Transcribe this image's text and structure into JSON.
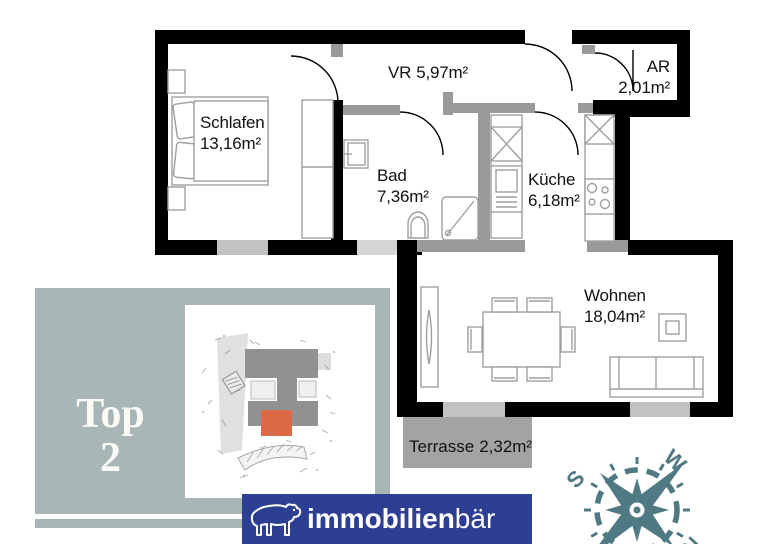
{
  "plan": {
    "rooms": [
      {
        "name": "Schlafen",
        "area": "13,16m²"
      },
      {
        "name": "VR",
        "area": "5,97m²"
      },
      {
        "name": "AR",
        "area": "2,01m²"
      },
      {
        "name": "Bad",
        "area": "7,36m²"
      },
      {
        "name": "Küche",
        "area": "6,18m²"
      },
      {
        "name": "Wohnen",
        "area": "18,04m²"
      },
      {
        "name": "Terrasse",
        "area": "2,32m²"
      }
    ]
  },
  "unit_badge": {
    "line1": "Top",
    "line2": "2"
  },
  "logo": {
    "text_bold": "immobilien",
    "text_light": "bär"
  },
  "compass": {
    "south": "S",
    "west": "W",
    "north": "N"
  },
  "colors": {
    "outer_wall": "#000000",
    "interior_wall": "#9a9a9a",
    "window": "#c2c2c2",
    "terrace_fill": "#a3a3a3",
    "badge_background": "#a8b6b8",
    "badge_text": "#fbfaf5",
    "logo_background": "#2d3f92",
    "logo_text": "#ffffff",
    "compass": "#507a83",
    "site_highlight_orange": "#dd6a44"
  }
}
